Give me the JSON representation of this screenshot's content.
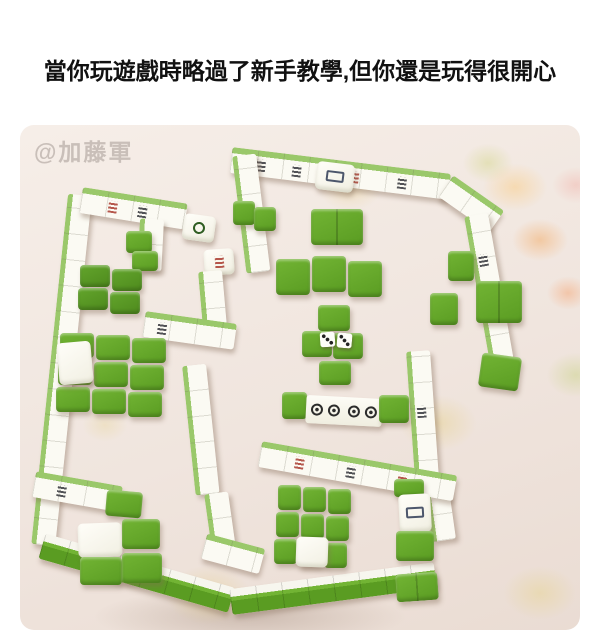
{
  "caption": {
    "text": "當你玩遊戲時略過了新手教學,但你還是玩得很開心"
  },
  "photo": {
    "watermark": "@加藤軍"
  },
  "colors": {
    "caption_color": "#111111",
    "watermark_color": "#c9bfb9",
    "carpet": "#f0e5de",
    "tile_white": "#fbfaf3",
    "tile_green": "#5a9c22",
    "tile_green_light": "#72b434",
    "tile_green_dark": "#4e8a1d"
  }
}
